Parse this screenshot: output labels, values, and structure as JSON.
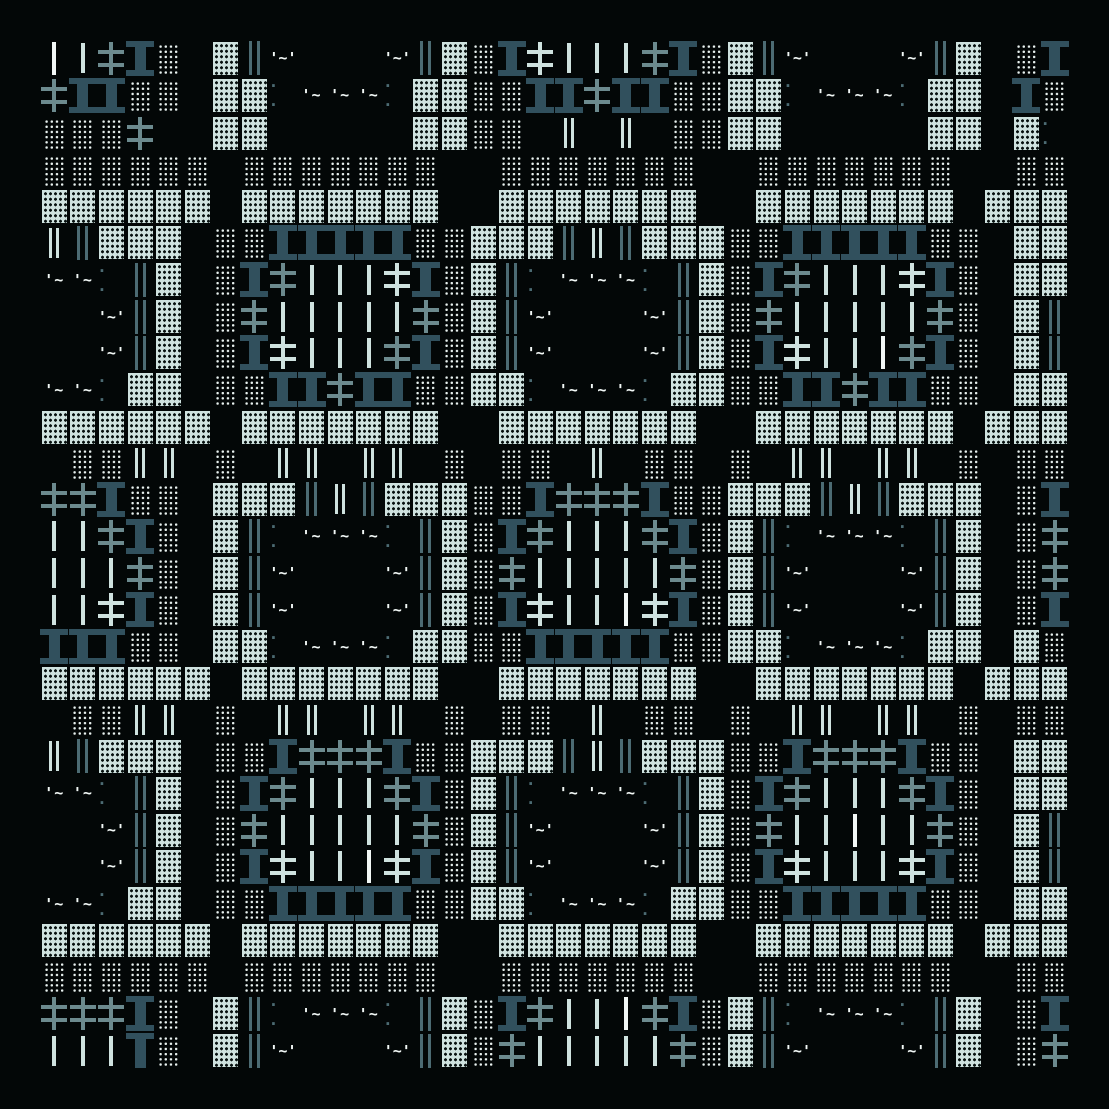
{
  "artwork": {
    "title": "glyph-quilt-pattern",
    "background": "#030707",
    "palette": {
      "mint": "#cfe2df",
      "white": "#f2f8f6",
      "slate": "#6c8a8e",
      "slate_dark": "#4c6b73",
      "slab_dark": "#31505d",
      "dot_white": "#e9f2f0"
    },
    "margin_px": 40,
    "grid": {
      "cols": 36,
      "rows": 28,
      "legend": {
        "l": {
          "name": "single-bar",
          "type": "shape"
        },
        "d": {
          "name": "double-bar-light",
          "type": "shape"
        },
        "D": {
          "name": "double-bar-slate",
          "type": "shape"
        },
        "+": {
          "name": "cross-light",
          "type": "shape"
        },
        "x": {
          "name": "cross-slate",
          "type": "shape"
        },
        "I": {
          "name": "slab-i",
          "type": "shape"
        },
        "T": {
          "name": "slab-t",
          "type": "shape"
        },
        "a": {
          "name": "halftone-block-mint",
          "type": "shape"
        },
        "b": {
          "name": "halftone-block-dots",
          "type": "shape"
        },
        "~": {
          "name": "tilde-motif",
          "type": "text",
          "text": "'~'"
        },
        "w": {
          "name": "wave-motif",
          "type": "text",
          "text": "'~"
        },
        ":": {
          "name": "dots-pair",
          "type": "text",
          "text": "· ·"
        },
        ".": {
          "name": "empty",
          "type": "empty"
        },
        " ": {
          "name": "empty",
          "type": "empty"
        }
      },
      "rows_data": [
        "llxIb aD~...~DabI+lllxIbaD~...~Da bI",
        "xIIbb aa:www:aabbIIxIIbbaa:www:aa Ib",
        "bbbx  aa     aabb d d bbaa     aa a:",
        "bbbbbb bbbbbbb  bbbbbbb  bbbbbbb  bb",
        "aaaaaa aaaaaaa  aaaaaaa  aaaaaaa aaa",
        "dDaaa bbIIIIIbbaaaDdDaaabbIIIIIbb aa",
        "ww:Da bIxlll+IbaD:www:DabIxlll+Ib aa",
        "..~Da bxlllllxbaD~...~Dabxlllllxb aD",
        "..~Da bI+lllxIbaD~...~DabI+lllxIb aD",
        "ww:aa bbIIxIIbbaa:www:aabbIIxIIbb aa",
        "aaaaaa aaaaaaa  aaaaaaa  aaaaaaa aaa",
        " bbdd b dd dd b bb d bb b dd dd b bb",
        "xxIbb aaaDdDaaabbIxxxIbbaaaDdDaaa bI",
        "llxIb aD:www:DabIxlllxIbaD:www:Da bx",
        "lllxb aD~...~DabxlllllxbaD~...~Da bx",
        "ll+Ib aD~...~DabI+lll+IbaD~...~Da bI",
        "IIIbb aa:www:aabbIIIIIbbaa:www:aa ab",
        "aaaaaa aaaaaaa  aaaaaaa  aaaaaaa aaa",
        " bbdd b dd dd b bb d bb b dd dd b bb",
        "dDaaa bbIxxxIbbaaaDdDaaabbIxxxIbb aa",
        "ww:Da bIxlllxIbaD:www:DabIxlllxIb aa",
        "..~Da bxlllllxbaD~...~Dabxlllllxb aD",
        "..~Da bI+lll+IbaD~...~DabI+lll+Ib aD",
        "ww:aa bbIIIIIbbaa:www:aabbIIIIIbb aa",
        "aaaaaa aaaaaaa  aaaaaaa  aaaaaaa aaa",
        "bbbbbb bbbbbbb  bbbbbbb  bbbbbbb  bb",
        "xxxIb aD:www:DabIxlllxIbaD:www:Da bI",
        "lllTb aD~...~DabxlllllxbaD~...~Da bx"
      ]
    }
  }
}
